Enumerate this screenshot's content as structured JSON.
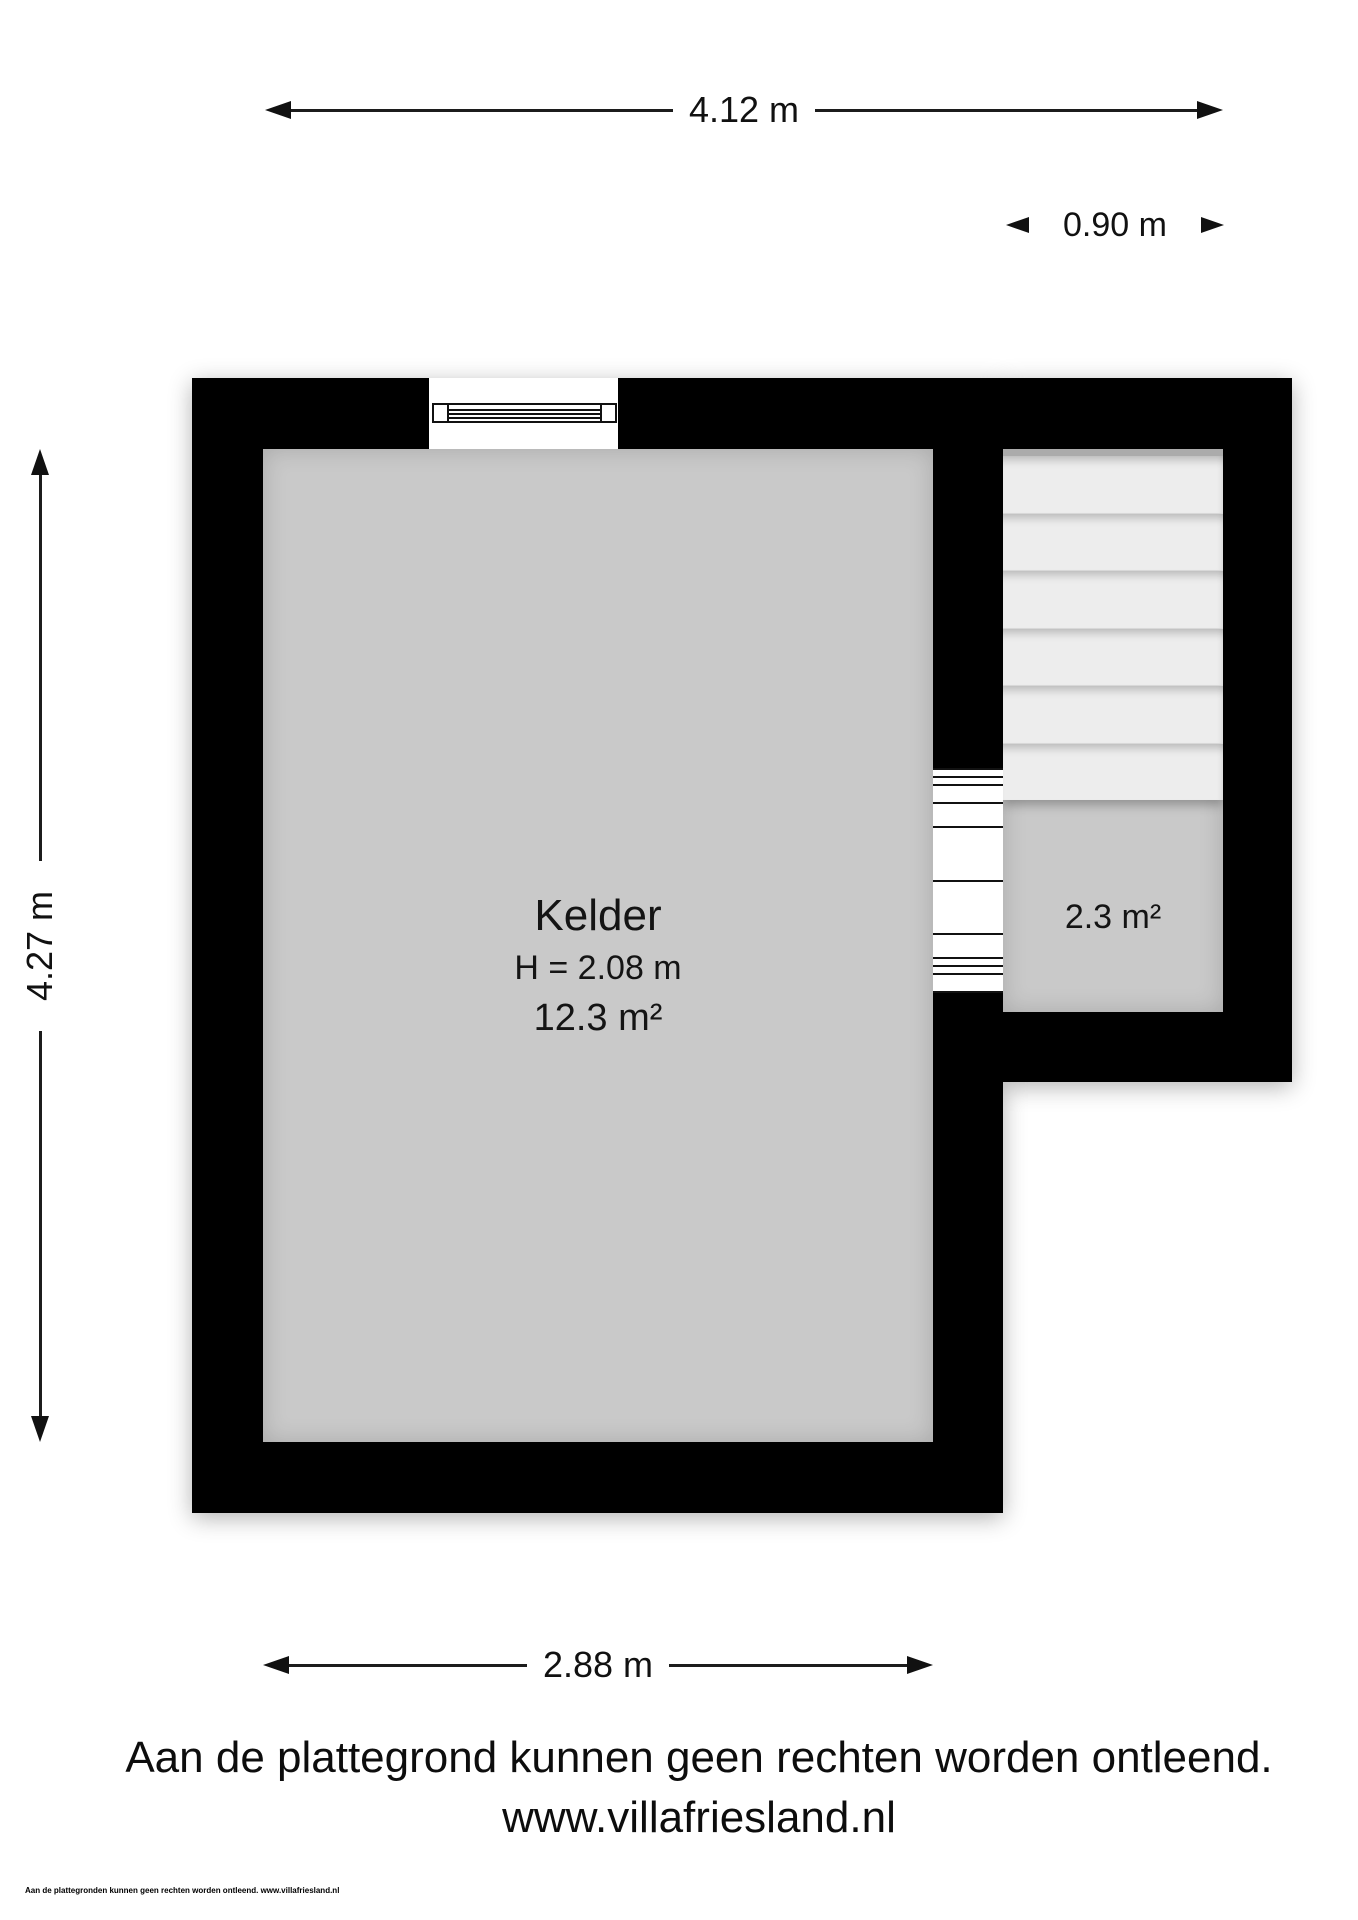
{
  "meta": {
    "title": "Kelder plattegrond"
  },
  "colors": {
    "wall": "#000000",
    "floor": "#c9c9c9",
    "stair_tread": "#ededed",
    "background": "#ffffff",
    "dimension_text": "#111111"
  },
  "dimensions": {
    "top_width": "4.12 m",
    "stair_width": "0.90 m",
    "left_height": "4.27 m",
    "bottom_width": "2.88 m"
  },
  "rooms": {
    "kelder": {
      "name": "Kelder",
      "ceiling_height": "H = 2.08 m",
      "area": "12.3 m²"
    },
    "stairwell": {
      "area": "2.3 m²"
    }
  },
  "footer": {
    "disclaimer": "Aan de plattegrond kunnen geen rechten worden ontleend.",
    "website": "www.villafriesland.nl",
    "fineprint": "Aan de plattegronden kunnen geen rechten worden ontleend. www.villafriesland.nl"
  }
}
